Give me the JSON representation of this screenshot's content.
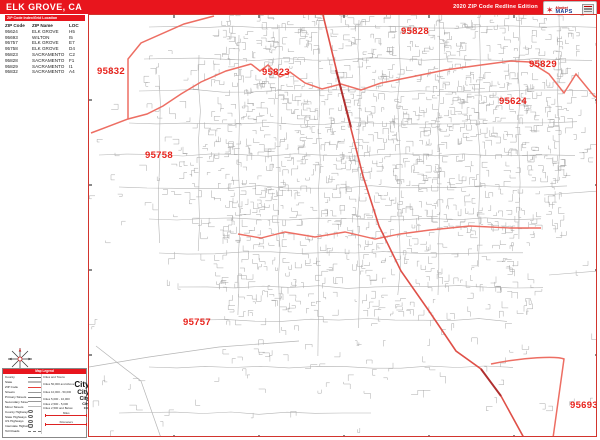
{
  "banner": {
    "title": "ELK GROVE, CA",
    "edition": "2020 ZIP Code Redline Edition",
    "logo_script": "Market",
    "logo_maps": "MAPS"
  },
  "index_table": {
    "title": "ZIP Code Index/Grid Location",
    "columns": [
      "ZIP Code",
      "ZIP Name",
      "LOC"
    ],
    "rows": [
      [
        "95624",
        "ELK GROVE",
        "H5"
      ],
      [
        "95693",
        "WILTON",
        "I5"
      ],
      [
        "95757",
        "ELK GROVE",
        "E7"
      ],
      [
        "95758",
        "ELK GROVE",
        "D4"
      ],
      [
        "95823",
        "SACRAMENTO",
        "C2"
      ],
      [
        "95828",
        "SACRAMENTO",
        "F1"
      ],
      [
        "95829",
        "SACRAMENTO",
        "I1"
      ],
      [
        "95832",
        "SACRAMENTO",
        "A4"
      ]
    ]
  },
  "legend": {
    "title": "Map Legend",
    "line_items": [
      {
        "label": "County",
        "style": ""
      },
      {
        "label": "State",
        "style": "state"
      },
      {
        "label": "ZIP Code",
        "style": "zip"
      },
      {
        "label": "Streets",
        "style": "street"
      },
      {
        "label": "Primary Streets",
        "style": "street1"
      },
      {
        "label": "Secondary Streets",
        "style": "street2"
      },
      {
        "label": "Minor Streets",
        "style": "street3"
      },
      {
        "label": "County Highways",
        "style": "hwy"
      },
      {
        "label": "State Highways",
        "style": "hwy"
      },
      {
        "label": "US Highways",
        "style": "hwy"
      },
      {
        "label": "Interstate Highways",
        "style": "hwyi"
      },
      {
        "label": "Toll Roads",
        "style": "toll"
      }
    ],
    "city_header": "Cities and Towns",
    "city_sample": "City",
    "city_items": [
      {
        "label": "Cities 50,000 and Above"
      },
      {
        "label": "Cities 10,000 - 50,000"
      },
      {
        "label": "Cities 5,000 - 10,000"
      },
      {
        "label": "Cities 2,500 - 5,000"
      },
      {
        "label": "Cities 2,500 and Below"
      }
    ],
    "scale_miles_label": "Miles",
    "scale_km_label": "Kilometers"
  },
  "map": {
    "zip_labels": [
      {
        "text": "95832",
        "x": 8,
        "y": 52
      },
      {
        "text": "95823",
        "x": 173,
        "y": 53
      },
      {
        "text": "95828",
        "x": 312,
        "y": 12
      },
      {
        "text": "95829",
        "x": 440,
        "y": 45
      },
      {
        "text": "95624",
        "x": 410,
        "y": 82
      },
      {
        "text": "95758",
        "x": 56,
        "y": 136
      },
      {
        "text": "95757",
        "x": 94,
        "y": 303
      },
      {
        "text": "95693",
        "x": 481,
        "y": 386
      }
    ],
    "colors": {
      "banner_red": "#e8151d",
      "zip_label_red": "#e8231c",
      "boundary_red": "#ed6e63",
      "railroad_red": "#df5048",
      "street_gray": "#9c9c9c"
    }
  }
}
